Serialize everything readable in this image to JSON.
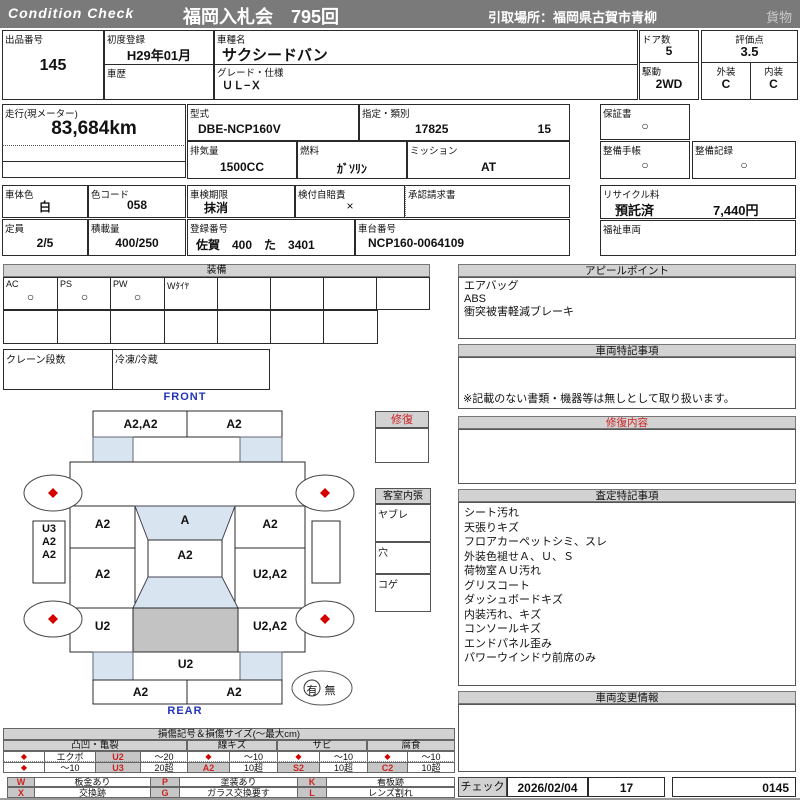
{
  "colors": {
    "bar-gray": "#7a7a7a",
    "header-gray": "#d2d2d2",
    "accent-red": "#cc2222",
    "diamond-red": "#d40000",
    "label-blue": "#2233bb",
    "window-blue": "#d9e4f1",
    "cargo-gray": "#c3c3c3",
    "cell-gray": "#c6c6c6"
  },
  "header": {
    "brand": "Condition  Check",
    "title": "福岡入札会　795回",
    "pickup": "引取場所：福岡県古賀市青柳",
    "category": "貨物"
  },
  "info": {
    "lot_label": "出品番号",
    "lot_no": "145",
    "first_reg_label": "初度登録",
    "first_reg": "H29年01月",
    "history_label": "車歴",
    "model_name_label": "車種名",
    "model_name": "サクシードバン",
    "grade_label": "グレード・仕様",
    "grade": "ＵＬ−Ｘ",
    "doors_label": "ドア数",
    "doors": "5",
    "drive_label": "駆動",
    "drive": "2WD",
    "score_label": "評価点",
    "score": "3.5",
    "exterior_label": "外装",
    "exterior": "C",
    "interior_label": "内装",
    "interior": "C",
    "mileage_label": "走行(現メーター)",
    "mileage": "83,684km",
    "model_code_label": "型式",
    "model_code": "DBE-NCP160V",
    "class_label": "指定・類別",
    "class_no1": "17825",
    "class_no2": "15",
    "warranty_label": "保証書",
    "warranty": "○",
    "displacement_label": "排気量",
    "displacement": "1500CC",
    "fuel_label": "燃料",
    "fuel": "ｶﾞｿﾘﾝ",
    "mission_label": "ミッション",
    "mission": "AT",
    "maintenance_book_label": "整備手帳",
    "maintenance_book": "○",
    "maintenance_record_label": "整備記録",
    "maintenance_record": "○",
    "body_color_label": "車体色",
    "body_color": "白",
    "color_code_label": "色コード",
    "color_code": "058",
    "inspection_label": "車検期限",
    "inspection": "抹消",
    "insurance_label": "検付自賠責",
    "insurance": "×",
    "approval_label": "承認請求書",
    "recycle_label": "リサイクル料",
    "recycle_status": "預託済",
    "recycle_fee": "7,440円",
    "capacity_label": "定員",
    "capacity": "2/5",
    "load_label": "積載量",
    "load": "400/250",
    "reg_no_label": "登録番号",
    "reg_no": "佐賀　400　た　3401",
    "chassis_label": "車台番号",
    "chassis_no": "NCP160-0064109",
    "welfare_label": "福祉車両"
  },
  "equipment": {
    "title": "装備",
    "items": [
      {
        "label": "AC",
        "value": "○"
      },
      {
        "label": "PS",
        "value": "○"
      },
      {
        "label": "PW",
        "value": "○"
      },
      {
        "label": "Wﾀｲﾔ",
        "value": ""
      }
    ],
    "crane_label": "クレーン段数",
    "fridge_label": "冷凍/冷蔵"
  },
  "diagram": {
    "front_label": "FRONT",
    "rear_label": "REAR",
    "zones": {
      "front_bumper_left": "A2,A2",
      "front_bumper_right": "A2",
      "windshield": "A",
      "roof": "A2",
      "left_1": "A2",
      "left_2": "A2",
      "left_3": "U2",
      "right_1": "A2",
      "right_2": "U2,A2",
      "right_3": "U2,A2",
      "side_left": [
        "U3",
        "A2",
        "A2"
      ],
      "tailgate": "U2",
      "rear_bumper_left": "A2",
      "rear_bumper_right": "A2"
    },
    "repair_label": "修復",
    "cabin_label": "客室内張",
    "cabin_rows": [
      "ヤブレ",
      "穴",
      "コゲ"
    ],
    "presence_yes": "有",
    "presence_no": "無"
  },
  "panels": {
    "appeal": {
      "title": "アピールポイント",
      "lines": [
        "エアバッグ",
        "ABS",
        "衝突被害軽減ブレーキ"
      ]
    },
    "special": {
      "title": "車両特記事項",
      "note": "※記載のない書類・機器等は無しとして取り扱います。"
    },
    "repair_detail": {
      "title": "修復内容"
    },
    "assessment": {
      "title": "査定特記事項",
      "lines": [
        "シート汚れ",
        "天張りキズ",
        "フロアカーペットシミ、スレ",
        "外装色褪せＡ、Ｕ、Ｓ",
        "荷物室ＡＵ汚れ",
        "グリスコート",
        "ダッシュボードキズ",
        "内装汚れ、キズ",
        "コンソールキズ",
        "エンドパネル歪み",
        "パワーウインドウ前席のみ"
      ]
    },
    "change_info": {
      "title": "車両変更情報"
    }
  },
  "legend": {
    "title": "損傷記号＆損傷サイズ(〜最大cm)",
    "groups": [
      "凸凹・亀裂",
      "線キズ",
      "サビ",
      "腐食"
    ],
    "diamond": "◆",
    "g1": {
      "rowA_name": "エクボ",
      "rowA_code": "U2",
      "rowA_size": "〜20",
      "rowB_name": "〜10",
      "rowB_code": "U3",
      "rowB_size": "20超"
    },
    "g2": {
      "rowA_size": "〜10",
      "rowB_code": "A2",
      "rowB_size": "10超"
    },
    "g3": {
      "rowA_size": "〜10",
      "rowB_code": "S2",
      "rowB_size": "10超"
    },
    "g4": {
      "rowA_size": "〜10",
      "rowB_code": "C2",
      "rowB_size": "10超"
    },
    "marks": [
      {
        "code": "W",
        "label": "板金あり"
      },
      {
        "code": "X",
        "label": "交換跡"
      },
      {
        "code": "P",
        "label": "塗装あり"
      },
      {
        "code": "G",
        "label": "ガラス交換要す"
      },
      {
        "code": "K",
        "label": "看板跡"
      },
      {
        "code": "L",
        "label": "レンズ割れ"
      }
    ]
  },
  "footer": {
    "check_label": "チェック",
    "date": "2026/02/04",
    "number": "17",
    "code": "0145"
  }
}
